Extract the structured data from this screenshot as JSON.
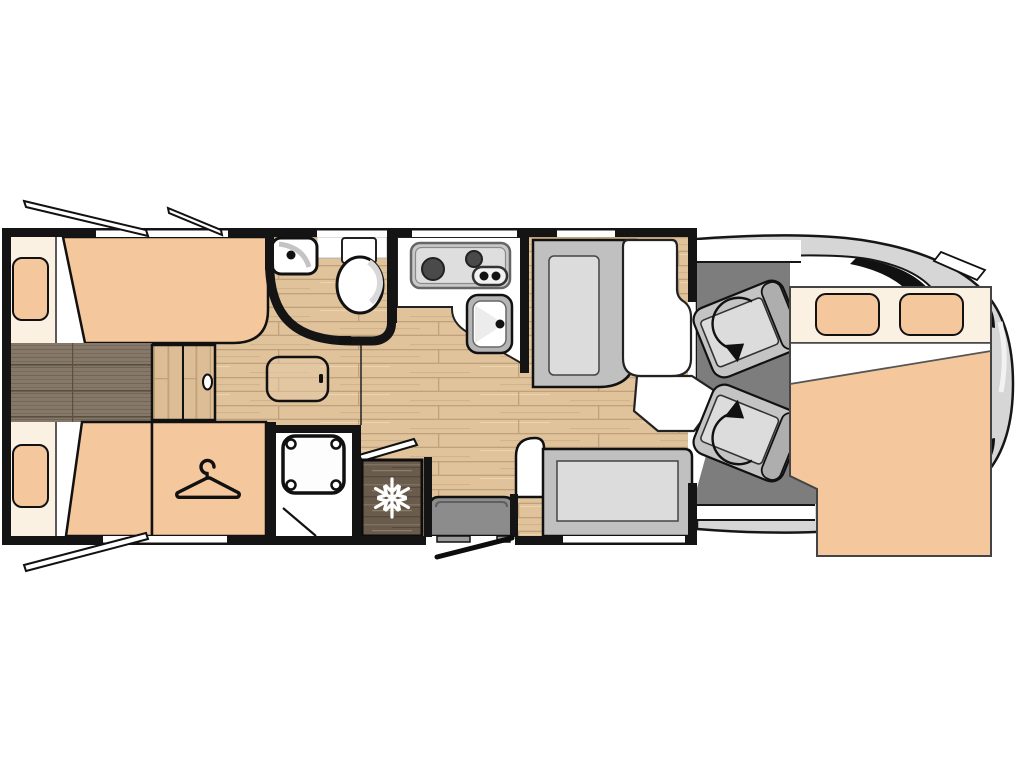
{
  "title": "Motorhome floor plan, top view, cab at right",
  "colors": {
    "peach": "#f5c79c",
    "cream": "#fbf1e3",
    "wall": "#141414",
    "wood_light": "#e0c29b",
    "wood_light_line": "#bfa27b",
    "wood_dark": "#867868",
    "wood_dark_line": "#6f6355",
    "fridge_wood": "#6a5c4c",
    "seat_gray": "#c0c0c0",
    "cushion_gray": "#dcdcdc",
    "cab_floor": "#7d7d7d",
    "body_gray": "#d6d6d6",
    "step_gray": "#8c8c8c"
  },
  "areas": {
    "rear_bedroom": {
      "label": "rear bedroom with two single beds",
      "items": [
        "single-bed-top",
        "single-bed-bottom",
        "pillow-top",
        "pillow-bottom",
        "center-step-chest",
        "wardrobe"
      ]
    },
    "bathroom": {
      "label": "washroom with corner basin and toilet behind curved wall",
      "items": [
        "corner-basin",
        "toilet",
        "curved-partition"
      ]
    },
    "shower_room": {
      "label": "separate shower cubicle",
      "items": [
        "shower-tray"
      ]
    },
    "kitchen": {
      "label": "L-shaped kitchen",
      "items": [
        "two-burner-hob",
        "kitchen-sink",
        "worktop"
      ]
    },
    "fridge": {
      "label": "refrigerator cabinet",
      "items": [
        "snowflake-marking"
      ]
    },
    "lounge": {
      "label": "lounge with forward seat, table and side sofa",
      "items": [
        "dinette-seat",
        "table",
        "sofa-bench",
        "armrest",
        "side-table"
      ]
    },
    "entrance": {
      "label": "entry door with step",
      "items": [
        "entry-step",
        "open-door"
      ]
    },
    "cab": {
      "label": "driving cab with two swivelling seats",
      "items": [
        "driver-seat",
        "passenger-seat",
        "windshield",
        "mirrors"
      ]
    },
    "drop_down_bed": {
      "label": "drop-down double bed over cab",
      "items": [
        "pillow-left",
        "pillow-right",
        "duvet"
      ]
    },
    "windows": {
      "label": "opening windows shown tilted out",
      "count": 3
    }
  },
  "icons": {
    "hanger": {
      "name": "hanger-icon",
      "meaning": "wardrobe"
    },
    "snowflake": {
      "name": "snowflake-icon",
      "meaning": "refrigerator",
      "glyph": "❄"
    },
    "swivel_arrow": {
      "name": "swivel-arrow-icon",
      "meaning": "seat rotates to face lounge"
    }
  }
}
